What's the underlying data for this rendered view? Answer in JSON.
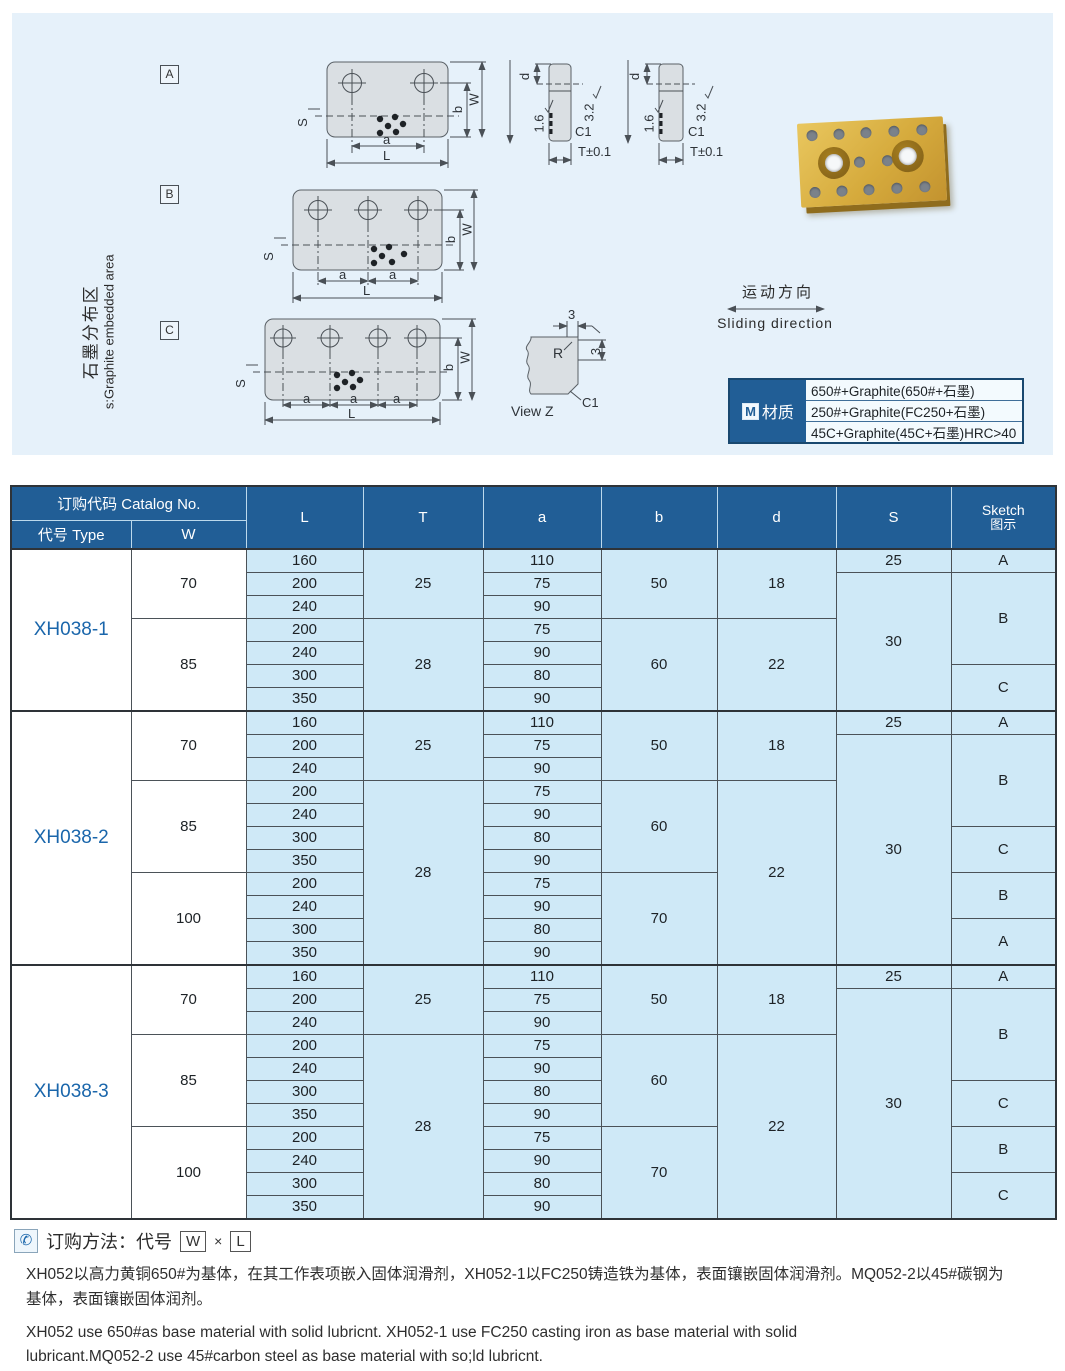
{
  "panel": {
    "caption_cn": "石墨分布区",
    "caption_en": "s:Graphite embedded area",
    "views": [
      "A",
      "B",
      "C"
    ],
    "dims": {
      "s": "S",
      "a": "a",
      "l": "L",
      "b": "b",
      "w": "W",
      "d": "d",
      "r16": "1.6",
      "r32": "3.2",
      "c1": "C1",
      "t": "T±0.1",
      "r": "R",
      "n3": "3",
      "viewz": "View Z"
    },
    "sliding_cn": "运动方向",
    "sliding_en": "Sliding direction",
    "material": {
      "label_m": "M",
      "label": "材质",
      "rows": [
        "650#+Graphite(650#+石墨)",
        "250#+Graphite(FC250+石墨)",
        "45C+Graphite(45C+石墨)HRC>40"
      ]
    }
  },
  "table": {
    "header": {
      "catalog": "订购代码 Catalog No.",
      "type": "代号 Type",
      "w": "W",
      "l": "L",
      "t": "T",
      "a": "a",
      "b": "b",
      "d": "d",
      "s": "S",
      "sketch_en": "Sketch",
      "sketch_cn": "图示"
    },
    "sections": [
      {
        "rows": [
          [
            [
              "XH038-1",
              7,
              "type"
            ],
            [
              "70",
              3,
              "wcol"
            ],
            [
              "160"
            ],
            [
              "25",
              3
            ],
            [
              "110"
            ],
            [
              "50",
              3
            ],
            [
              "18",
              3
            ],
            [
              "25"
            ],
            [
              "A"
            ]
          ],
          [
            [
              "200"
            ],
            [
              "75"
            ],
            [
              "30",
              6
            ],
            [
              "B",
              4
            ]
          ],
          [
            [
              "240"
            ],
            [
              "90"
            ]
          ],
          [
            [
              "85",
              4,
              "wcol"
            ],
            [
              "200"
            ],
            [
              "28",
              4
            ],
            [
              "75"
            ],
            [
              "60",
              4
            ],
            [
              "22",
              4
            ]
          ],
          [
            [
              "240"
            ],
            [
              "90"
            ]
          ],
          [
            [
              "300"
            ],
            [
              "80"
            ],
            [
              "C",
              2
            ]
          ],
          [
            [
              "350"
            ],
            [
              "90"
            ]
          ]
        ]
      },
      {
        "rows": [
          [
            [
              "XH038-2",
              11,
              "type"
            ],
            [
              "70",
              3,
              "wcol"
            ],
            [
              "160"
            ],
            [
              "25",
              3
            ],
            [
              "110"
            ],
            [
              "50",
              3
            ],
            [
              "18",
              3
            ],
            [
              "25"
            ],
            [
              "A"
            ]
          ],
          [
            [
              "200"
            ],
            [
              "75"
            ],
            [
              "30",
              10
            ],
            [
              "B",
              4
            ]
          ],
          [
            [
              "240"
            ],
            [
              "90"
            ]
          ],
          [
            [
              "85",
              4,
              "wcol"
            ],
            [
              "200"
            ],
            [
              "28",
              8
            ],
            [
              "75"
            ],
            [
              "60",
              4
            ],
            [
              "22",
              8
            ]
          ],
          [
            [
              "240"
            ],
            [
              "90"
            ]
          ],
          [
            [
              "300"
            ],
            [
              "80"
            ],
            [
              "C",
              2
            ]
          ],
          [
            [
              "350"
            ],
            [
              "90"
            ]
          ],
          [
            [
              "100",
              4,
              "wcol"
            ],
            [
              "200"
            ],
            [
              "75"
            ],
            [
              "70",
              4
            ],
            [
              "B",
              2
            ]
          ],
          [
            [
              "240"
            ],
            [
              "90"
            ]
          ],
          [
            [
              "300"
            ],
            [
              "80"
            ],
            [
              "A",
              2
            ]
          ],
          [
            [
              "350"
            ],
            [
              "90"
            ]
          ]
        ]
      },
      {
        "rows": [
          [
            [
              "XH038-3",
              11,
              "type"
            ],
            [
              "70",
              3,
              "wcol"
            ],
            [
              "160"
            ],
            [
              "25",
              3
            ],
            [
              "110"
            ],
            [
              "50",
              3
            ],
            [
              "18",
              3
            ],
            [
              "25"
            ],
            [
              "A"
            ]
          ],
          [
            [
              "200"
            ],
            [
              "75"
            ],
            [
              "30",
              10
            ],
            [
              "B",
              4
            ]
          ],
          [
            [
              "240"
            ],
            [
              "90"
            ]
          ],
          [
            [
              "85",
              4,
              "wcol"
            ],
            [
              "200"
            ],
            [
              "28",
              8
            ],
            [
              "75"
            ],
            [
              "60",
              4
            ],
            [
              "22",
              8
            ]
          ],
          [
            [
              "240"
            ],
            [
              "90"
            ]
          ],
          [
            [
              "300"
            ],
            [
              "80"
            ],
            [
              "C",
              2
            ]
          ],
          [
            [
              "350"
            ],
            [
              "90"
            ]
          ],
          [
            [
              "100",
              4,
              "wcol"
            ],
            [
              "200"
            ],
            [
              "75"
            ],
            [
              "70",
              4
            ],
            [
              "B",
              2
            ]
          ],
          [
            [
              "240"
            ],
            [
              "90"
            ]
          ],
          [
            [
              "300"
            ],
            [
              "80"
            ],
            [
              "C",
              2
            ]
          ],
          [
            [
              "350"
            ],
            [
              "90"
            ]
          ]
        ]
      }
    ]
  },
  "footer": {
    "phone_icon": "✆",
    "order_label": "订购方法：代号",
    "w_box": "W",
    "times": "×",
    "l_box": "L",
    "cn": "XH052以高力黄铜650#为基体，在其工作表项嵌入固体润滑剂，XH052-1以FC250铸造铁为基体，表面镶嵌固体润滑剂。MQ052-2以45#碳钢为基体，表面镶嵌固体润剂。",
    "en": "XH052 use 650#as base material with solid lubricnt. XH052-1 use FC250 casting iron as base material with solid lubricant.MQ052-2 use 45#carbon steel as base material with so;ld lubricnt."
  }
}
